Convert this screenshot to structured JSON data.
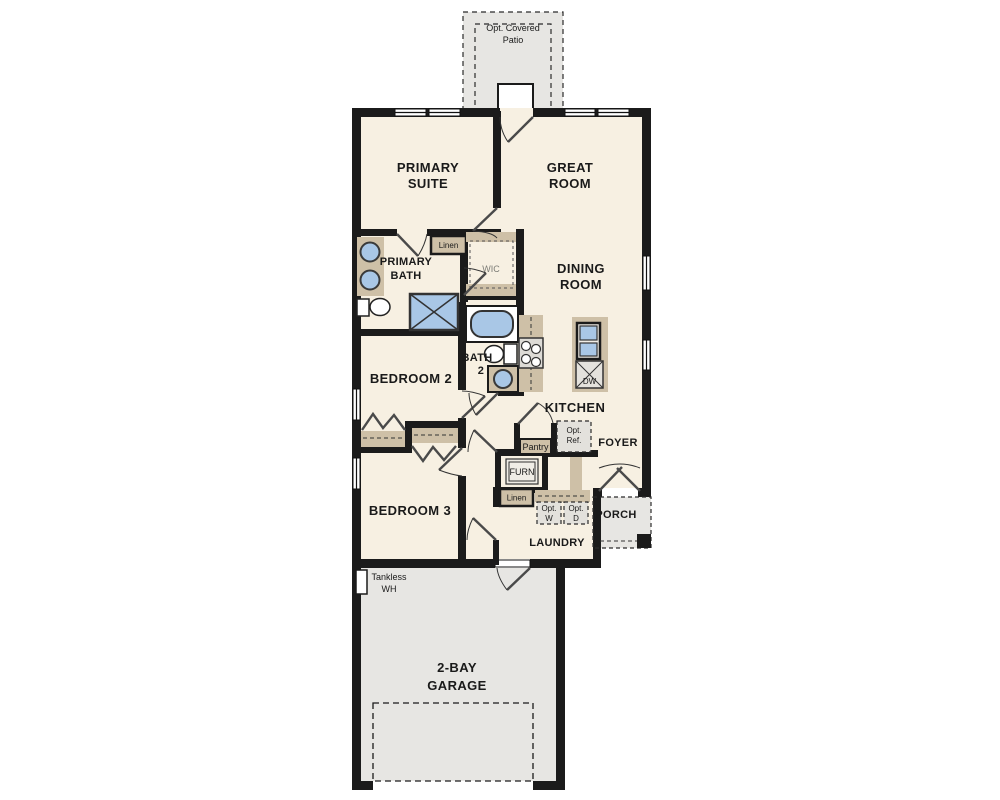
{
  "plan": {
    "patio": {
      "line1": "Opt. Covered",
      "line2": "Patio"
    },
    "primary_suite": {
      "line1": "PRIMARY",
      "line2": "SUITE"
    },
    "great_room": {
      "line1": "GREAT",
      "line2": "ROOM"
    },
    "primary_bath": {
      "line1": "PRIMARY",
      "line2": "BATH"
    },
    "linen_bath": {
      "label": "Linen"
    },
    "wic": {
      "label": "WIC"
    },
    "dining": {
      "line1": "DINING",
      "line2": "ROOM"
    },
    "bedroom2": {
      "label": "BEDROOM 2"
    },
    "bath2": {
      "line1": "BATH",
      "line2": "2"
    },
    "kitchen": {
      "label": "KITCHEN"
    },
    "dw": {
      "label": "DW"
    },
    "pantry": {
      "label": "Pantry"
    },
    "opt_ref": {
      "line1": "Opt.",
      "line2": "Ref."
    },
    "foyer": {
      "label": "FOYER"
    },
    "furn": {
      "label": "FURN"
    },
    "linen_hall": {
      "label": "Linen"
    },
    "opt_w": {
      "line1": "Opt.",
      "line2": "W"
    },
    "opt_d": {
      "line1": "Opt.",
      "line2": "D"
    },
    "porch": {
      "label": "PORCH"
    },
    "laundry": {
      "label": "LAUNDRY"
    },
    "bedroom3": {
      "label": "BEDROOM 3"
    },
    "tankless_wh": {
      "line1": "Tankless",
      "line2": "WH"
    },
    "garage": {
      "line1": "2-BAY",
      "line2": "GARAGE"
    }
  },
  "colors": {
    "floor": "#f7f0e2",
    "hardscape": "#e7e6e3",
    "wall": "#1b1b1b",
    "cabinet": "#cec0a7",
    "fixture_blue": "#a9c7e6",
    "label_text": "#1a1a1a"
  }
}
